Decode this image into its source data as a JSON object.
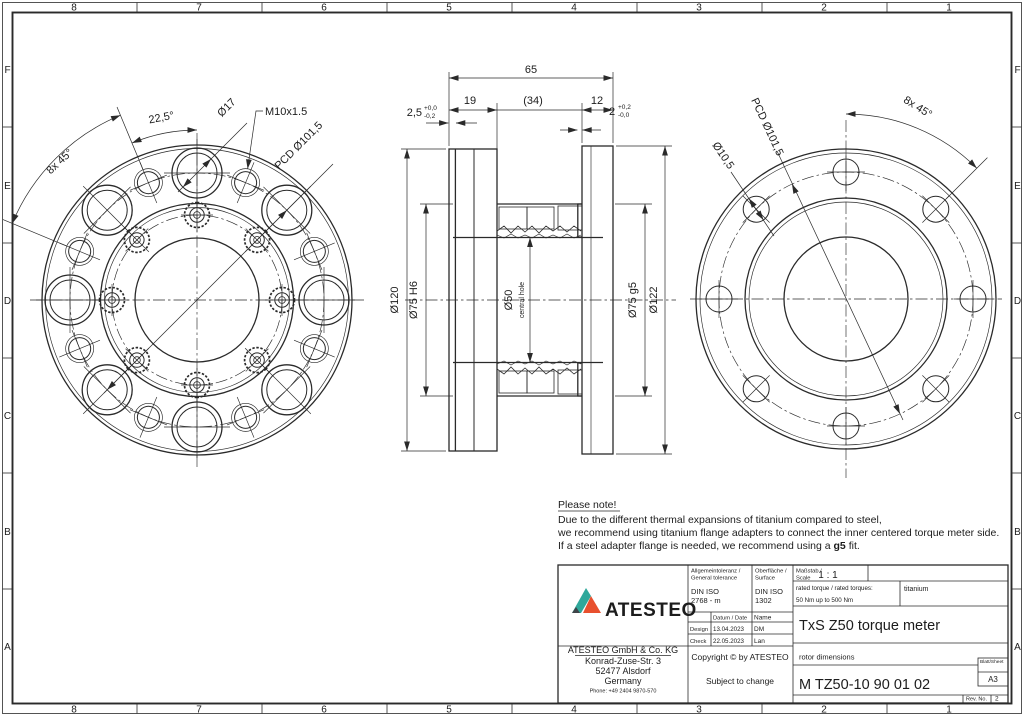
{
  "frame": {
    "columns": [
      "8",
      "7",
      "6",
      "5",
      "4",
      "3",
      "2",
      "1"
    ],
    "rows": [
      "F",
      "E",
      "D",
      "C",
      "B",
      "A"
    ]
  },
  "front_view": {
    "angle_spacing": "22,5°",
    "hole_diameter": "Ø17",
    "thread": "M10x1.5",
    "pcd": "PCD Ø101,5",
    "pattern": "8x 45°"
  },
  "section_view": {
    "total_width": "65",
    "left_width": "19",
    "middle_width": "(34)",
    "right_width": "12",
    "lip_left": "2,5",
    "lip_left_tol_top": "+0,0",
    "lip_left_tol_bot": "-0,2",
    "lip_right": "2",
    "lip_right_tol_top": "+0,2",
    "lip_right_tol_bot": "-0,0",
    "d120": "Ø120",
    "d75h6": "Ø75 H6",
    "d50": "Ø50",
    "d50_sub": "central hole",
    "d75g5": "Ø75 g5",
    "d122": "Ø122"
  },
  "back_view": {
    "pcd": "PCD Ø101,5",
    "hole_diameter": "Ø10,5",
    "pattern": "8x 45°"
  },
  "note": {
    "title": "Please note!",
    "line1": "Due to the different thermal expansions of titanium compared to steel,",
    "line2": "we recommend using titanium flange adapters to connect the inner centered torque meter side.",
    "line3a": "If a steel adapter flange is needed, we recommend using a ",
    "line3b": "g5",
    "line3c": " fit."
  },
  "title_block": {
    "logo_text": "ATESTEO",
    "colors": {
      "logo_teal": "#2FA89B",
      "logo_orange": "#E8502E",
      "logo_dark": "#3F4449"
    },
    "general_tolerance_label1": "Allgemeintoleranz /",
    "general_tolerance_label2": "General tolerance",
    "general_tolerance_value1": "DIN ISO",
    "general_tolerance_value2": "2768 - m",
    "surface_label1": "Oberfläche /",
    "surface_label2": "Surface",
    "surface_value1": "DIN ISO",
    "surface_value2": "1302",
    "scale_label1": "Maßstab /",
    "scale_label2": "Scale",
    "scale_value": "1 : 1",
    "rated_torque_label": "rated torque / rated torques:",
    "rated_torque_value": "50 Nm up to 500 Nm",
    "material": "titanium",
    "date_header": "Datum / Date",
    "name_header": "Name",
    "design_label": "Design",
    "design_date": "13.04.2023",
    "design_name": "DM",
    "check_label": "Check",
    "check_date": "22.05.2023",
    "check_name": "Lan",
    "product_title": "TxS Z50 torque meter",
    "subtitle": "rotor dimensions",
    "drawing_number": "M TZ50-10 90 01 02",
    "sheet_label": "Blatt/Sheet",
    "sheet_value": "A3",
    "rev_label": "Rev. No.",
    "rev_value": "2",
    "company_name": "ATESTEO GmbH & Co. KG",
    "street": "Konrad-Zuse-Str. 3",
    "city": "52477 Alsdorf",
    "country": "Germany",
    "phone": "Phone: +49 2404 9870-570",
    "copyright": "Copyright © by ATESTEO",
    "change_note": "Subject to change"
  }
}
